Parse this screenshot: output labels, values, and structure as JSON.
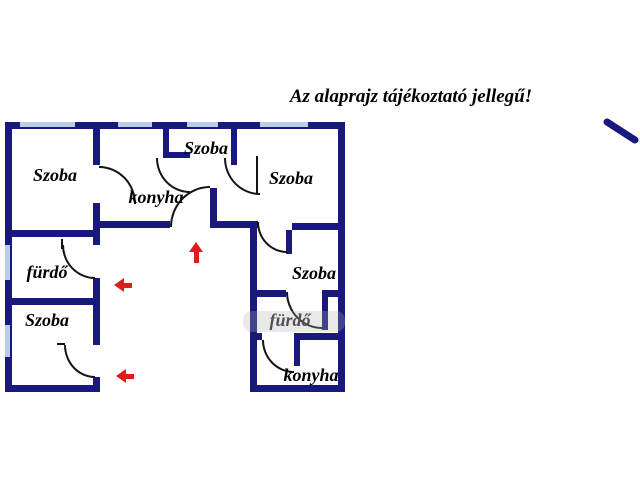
{
  "title": "Az alaprajz tájékoztató jellegű!",
  "rooms": [
    {
      "id": "szoba-top-left",
      "label": "Szoba"
    },
    {
      "id": "konyha-top",
      "label": "konyha"
    },
    {
      "id": "szoba-top-middle",
      "label": "Szoba"
    },
    {
      "id": "szoba-top-right",
      "label": "Szoba"
    },
    {
      "id": "furdo-left",
      "label": "fürdő"
    },
    {
      "id": "szoba-bottom-left",
      "label": "Szoba"
    },
    {
      "id": "szoba-right-column",
      "label": "Szoba"
    },
    {
      "id": "furdo-right-column",
      "label": "fürdő"
    },
    {
      "id": "konyha-right-column",
      "label": "konyha"
    }
  ],
  "arrows": [
    {
      "id": "entrance-arrow-up",
      "direction": "up"
    },
    {
      "id": "entrance-arrow-left-1",
      "direction": "left"
    },
    {
      "id": "entrance-arrow-left-2",
      "direction": "left"
    }
  ],
  "colors": {
    "wall": "#18187f",
    "window": "#b9cfe8",
    "arrow_red": "#da1f1c",
    "label": "#000000",
    "faded_label": "#4f4f55"
  }
}
